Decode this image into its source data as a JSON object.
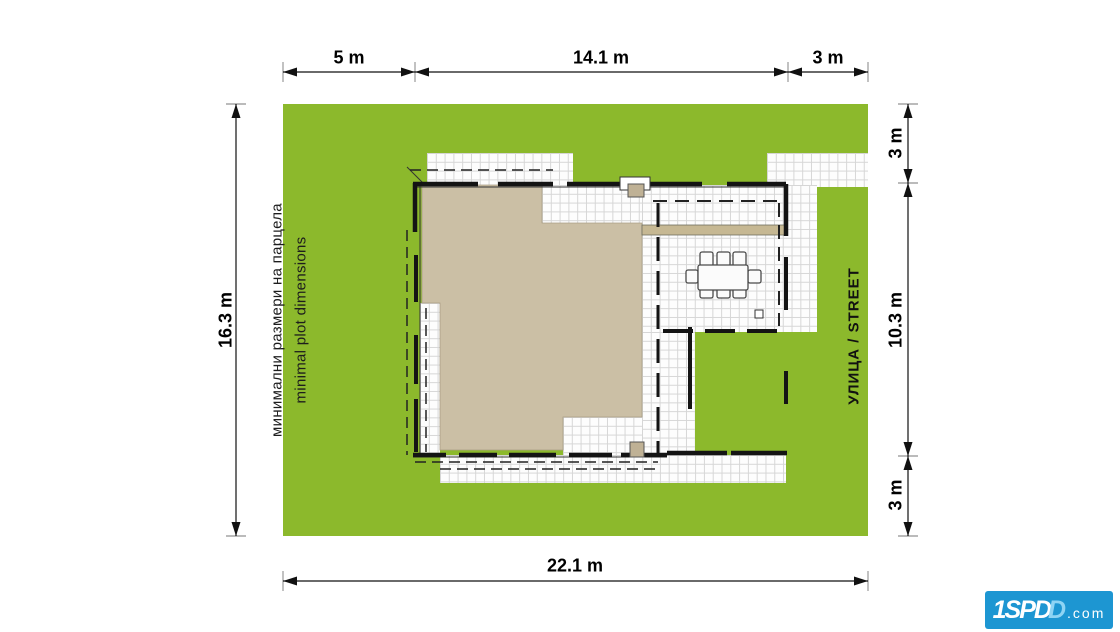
{
  "plot": {
    "label_bg": "минимални размери на парцела",
    "label_en": "minimal plot dimensions",
    "street_label": "УЛИЦА / STREET"
  },
  "dimensions": {
    "top": [
      {
        "label": "5 m"
      },
      {
        "label": "14.1 m"
      },
      {
        "label": "3 m"
      }
    ],
    "left": {
      "label": "16.3 m"
    },
    "right": [
      {
        "label": "3 m"
      },
      {
        "label": "10.3 m"
      },
      {
        "label": "3 m"
      }
    ],
    "bottom": {
      "label": "22.1 m"
    }
  },
  "logo": {
    "part1": "1SPD",
    "part2": "D",
    "part3": ".com",
    "background": "#1d96d2"
  },
  "colors": {
    "plot_green": "#8cb92c",
    "roof_beige": "#cbbfa5",
    "beam_tan": "#c6b893",
    "line_black": "#141414",
    "logo_blue": "#1d96d2"
  }
}
